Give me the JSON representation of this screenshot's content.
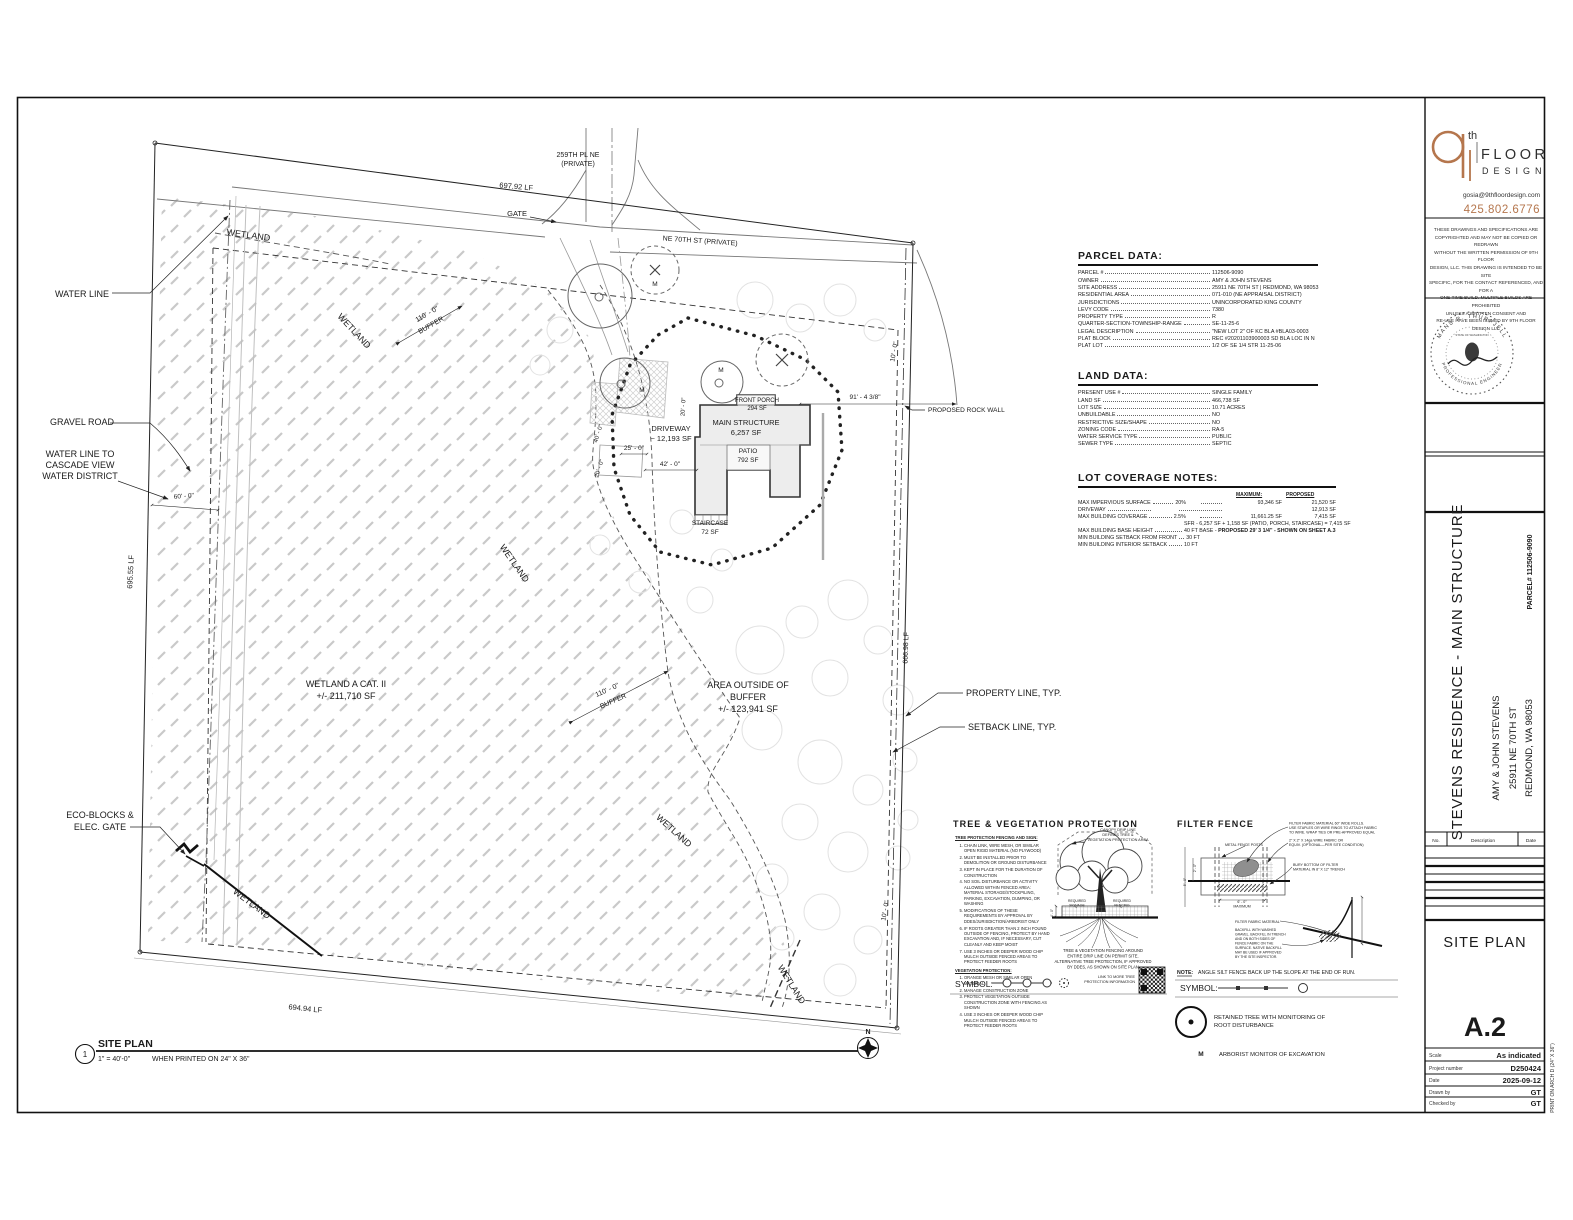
{
  "brand": {
    "sup": "th",
    "floor": "FLOOR",
    "design": "DESIGN",
    "email": "gosia@9thfloordesign.com",
    "phone": "425.802.6776",
    "accent": "#b5764d"
  },
  "copyright_lines": [
    "THESE DRAWINGS AND SPECIFICATIONS ARE",
    "COPYRIGHTED AND MAY NOT BE COPIED OR REDRAWN",
    "WITHOUT THE WRITTEN PERMISSION OF 9TH FLOOR",
    "DESIGN, LLC. THIS DRAWING IS INTENDED TO BE SITE",
    "SPECIFIC, FOR THE CONTACT REFERENCED, AND FOR A",
    "ONE-TIME BUILD. MULTIPLE BUILDS ARE PROHIBITED",
    "UNLESS A WRITTEN CONSENT AND",
    "RE-USE HAVE BEEN ISSUED BY 9TH FLOOR DESIGN LLC"
  ],
  "stamp": {
    "name": "MANS R. THURFJELL",
    "title": "PROFESSIONAL ENGINEER",
    "state": "STATE OF WASHINGTON"
  },
  "project": {
    "title": "STEVENS RESIDENCE - MAIN STRUCTURE",
    "client": "AMY & JOHN STEVENS",
    "address1": "25911 NE 70TH ST",
    "address2": "REDMOND, WA 98053",
    "parcel": "PARCEL# 112506-9090"
  },
  "revisions": {
    "no": "No.",
    "description": "Description",
    "date": "Date"
  },
  "titleblock": {
    "sheet_name": "SITE PLAN",
    "sheet_number": "A.2",
    "rows": [
      {
        "label": "Scale",
        "value": "As indicated"
      },
      {
        "label": "Project number",
        "value": "D250424"
      },
      {
        "label": "Date",
        "value": "2025-09-12"
      },
      {
        "label": "Drawn by",
        "value": "GT"
      },
      {
        "label": "Checked by",
        "value": "GT"
      }
    ],
    "print_note": "PRINT ON ARCH D (24\" X 36\")"
  },
  "parcel_data": {
    "title": "PARCEL DATA:",
    "rows": [
      {
        "l": "PARCEL #",
        "v": "112506-9090"
      },
      {
        "l": "OWNER",
        "v": "AMY & JOHN STEVENS"
      },
      {
        "l": "SITE ADDRESS",
        "v": "25911 NE 70TH ST  |  REDMOND, WA 98053"
      },
      {
        "l": "RESIDENTIAL AREA",
        "v": "071-010 (NE APPRAISAL DISTRICT)"
      },
      {
        "l": "JURISDICTIONS",
        "v": "UNINCORPORATED KING COUNTY"
      },
      {
        "l": "LEVY CODE",
        "v": "7380"
      },
      {
        "l": "PROPERTY TYPE",
        "v": "R"
      },
      {
        "l": "QUARTER-SECTION-TOWNSHIP-RANGE",
        "v": "SE-11-25-6"
      },
      {
        "l": "LEGAL DESCRIPTION",
        "v": "\"NEW LOT 2\" OF KC BLA #BLA03-0003"
      },
      {
        "l": "PLAT BLOCK",
        "v": "REC #20201103900003 SD BLA LOC IN N"
      },
      {
        "l": "PLAT LOT",
        "v": "1/2 OF SE 1/4 STR 11-25-06"
      }
    ]
  },
  "land_data": {
    "title": "LAND DATA:",
    "rows": [
      {
        "l": "PRESENT USE #",
        "v": "SINGLE FAMILY"
      },
      {
        "l": "LAND SF",
        "v": "466,738 SF"
      },
      {
        "l": "LOT SIZE",
        "v": "10.71 ACRES"
      },
      {
        "l": "UNBUILDABLE",
        "v": "NO"
      },
      {
        "l": "RESTRICTIVE SIZE/SHAPE",
        "v": "NO"
      },
      {
        "l": "ZONING CODE",
        "v": "RA-5"
      },
      {
        "l": "WATER SERVICE TYPE",
        "v": "PUBLIC"
      },
      {
        "l": "SEWER TYPE",
        "v": "SEPTIC"
      }
    ]
  },
  "lot_coverage": {
    "title": "LOT COVERAGE NOTES:",
    "col_maximum": "MAXIMUM:",
    "col_proposed": "PROPOSED",
    "rows": [
      {
        "l": "MAX IMPERVIOUS SURFACE",
        "m": "20%",
        "x": "93,346 SF",
        "p": "21,520 SF"
      },
      {
        "l": "DRIVEWAY",
        "m": "",
        "x": "",
        "p": "12,913 SF"
      },
      {
        "l": "MAX BUILDING COVERAGE",
        "m": "2.5%",
        "x": "11,661.25 SF",
        "p": "7,415 SF"
      },
      {
        "note": "SFR - 6,257 SF + 1,158 SF (PATIO, PORCH, STAIRCASE)  = 7,415 SF"
      },
      {
        "l": "MAX BUILDING BASE HEIGHT",
        "w": "40 FT BASE - ",
        "wb": "PROPOSED 29' 3 1/4\" - SHOWN ON SHEET A.3"
      },
      {
        "l": "MIN BUILDING SETBACK FROM FRONT",
        "w": "30 FT"
      },
      {
        "l": "MIN BUILDING INTERIOR SETBACK",
        "w": "10 FT"
      }
    ]
  },
  "tree_detail": {
    "sec1_title": "TREE PROTECTION FENCING AND SIGN:",
    "sec1": [
      "CHAIN LINK, WIRE MESH, OR SIMILAR OPEN RIGID MATERIAL (NO PLYWOOD)",
      "MUST BE INSTALLED PRIOR TO DEMOLITION OR GROUND DISTURBANCE",
      "KEPT IN PLACE FOR THE DURATION OF CONSTRUCTION",
      "NO SOIL DISTURBANCE OR ACTIVITY ALLOWED WITHIN FENCED AREA: MATERIAL STORAGE/STOCKPILING, PARKING, EXCAVATION, DUMPING, OR WASHING",
      "MODIFICATIONS OF THESE REQUIREMENTS BY APPROVAL BY DDES/JURISDICTION/ARBORIST ONLY",
      "IF ROOTS GREATER THAN 2 INCH FOUND OUTSIDE OF FENCING, PROTECT BY HAND EXCAVATION AND, IF NECESSARY, CUT CLEANLY AND KEEP MOIST",
      "USE 3 INCHES OR DEEPER WOOD CHIP MULCH OUTSIDE FENCED AREAS TO PROTECT FEEDER ROOTS"
    ],
    "sec2_title": "VEGETATION PROTECTION:",
    "sec2": [
      "ORANGE MESH OR SIMILAR OPEN MATERIAL",
      "MANAGE CONSTRUCTION ZONE",
      "PROTECT VEGETATION OUTSIDE CONSTRUCTION ZONE WITH FENCING AS SHOWN",
      "USE 3 INCHES OR DEEPER WOOD CHIP MULCH OUTSIDE FENCED AREAS TO PROTECT FEEDER ROOTS"
    ]
  },
  "labels": [
    {
      "t": "TREE & VEGETATION PROTECTION",
      "x": 953,
      "y": 827,
      "s": 9,
      "a": "s",
      "b": 1,
      "ls": 1.1
    },
    {
      "t": "FILTER FENCE",
      "x": 1177,
      "y": 827,
      "s": 9,
      "a": "s",
      "b": 1,
      "ls": 1.1
    },
    {
      "t": "WETLAND",
      "x": 248,
      "y": 238,
      "s": 9,
      "r": 8
    },
    {
      "t": "WATER LINE",
      "x": 82,
      "y": 297,
      "s": 9
    },
    {
      "t": "WETLAND",
      "x": 352,
      "y": 333,
      "s": 9,
      "r": 47
    },
    {
      "t": "110' - 0\"",
      "x": 428,
      "y": 316,
      "s": 7,
      "r": -30
    },
    {
      "t": "BUFFER",
      "x": 432,
      "y": 327,
      "s": 7,
      "r": -30
    },
    {
      "t": "GRAVEL ROAD",
      "x": 82,
      "y": 425,
      "s": 9
    },
    {
      "t": "WATER LINE TO",
      "x": 80,
      "y": 457,
      "s": 9
    },
    {
      "t": "CASCADE VIEW",
      "x": 80,
      "y": 468,
      "s": 9
    },
    {
      "t": "WATER DISTRICT",
      "x": 80,
      "y": 479,
      "s": 9
    },
    {
      "t": "60' - 0\"",
      "x": 184,
      "y": 498,
      "s": 6.5,
      "r": -4
    },
    {
      "t": "695.55 LF",
      "x": 133,
      "y": 572,
      "s": 7.5,
      "r": -87
    },
    {
      "t": "WETLAND A CAT. II",
      "x": 346,
      "y": 687,
      "s": 9
    },
    {
      "t": "+/- 211,710 SF",
      "x": 346,
      "y": 699,
      "s": 9
    },
    {
      "t": "WETLAND",
      "x": 512,
      "y": 565,
      "s": 9,
      "r": 55
    },
    {
      "t": "WETLAND",
      "x": 672,
      "y": 833,
      "s": 9,
      "r": 42
    },
    {
      "t": "110' - 0\"",
      "x": 608,
      "y": 692,
      "s": 7,
      "r": -24
    },
    {
      "t": "BUFFER",
      "x": 614,
      "y": 703,
      "s": 7,
      "r": -24
    },
    {
      "t": "AREA OUTSIDE OF",
      "x": 748,
      "y": 688,
      "s": 9
    },
    {
      "t": "BUFFER",
      "x": 748,
      "y": 700,
      "s": 9
    },
    {
      "t": "+/- 123,941 SF",
      "x": 748,
      "y": 712,
      "s": 9
    },
    {
      "t": "PROPERTY LINE, TYP.",
      "x": 966,
      "y": 696,
      "s": 9,
      "a": "s"
    },
    {
      "t": "SETBACK LINE, TYP.",
      "x": 968,
      "y": 730,
      "s": 9,
      "a": "s"
    },
    {
      "t": "PROPOSED ROCK WALL",
      "x": 928,
      "y": 412,
      "s": 6.5,
      "a": "s"
    },
    {
      "t": "666.98 LF",
      "x": 908,
      "y": 648,
      "s": 7,
      "r": -88
    },
    {
      "t": "10' - 0\"",
      "x": 896,
      "y": 352,
      "s": 6.5,
      "r": -80
    },
    {
      "t": "10' - 0\"",
      "x": 887,
      "y": 911,
      "s": 6.5,
      "r": -80
    },
    {
      "t": "ECO-BLOCKS &",
      "x": 100,
      "y": 818,
      "s": 9
    },
    {
      "t": "ELEC. GATE",
      "x": 100,
      "y": 830,
      "s": 9
    },
    {
      "t": "WETLAND",
      "x": 250,
      "y": 906,
      "s": 9,
      "r": 37
    },
    {
      "t": "WETLAND",
      "x": 789,
      "y": 986,
      "s": 9,
      "r": 58
    },
    {
      "t": "694.94 LF",
      "x": 305,
      "y": 1011,
      "s": 7.5,
      "r": 6
    },
    {
      "t": "GATE",
      "x": 527,
      "y": 216,
      "s": 7.5,
      "a": "e"
    },
    {
      "t": "697.92 LF",
      "x": 516,
      "y": 189,
      "s": 7.5,
      "r": 5
    },
    {
      "t": "259TH PL NE",
      "x": 578,
      "y": 157,
      "s": 7
    },
    {
      "t": "(PRIVATE)",
      "x": 578,
      "y": 166,
      "s": 7
    },
    {
      "t": "NE 70TH ST (PRIVATE)",
      "x": 700,
      "y": 243,
      "s": 7,
      "r": 4
    },
    {
      "t": "FRONT PORCH",
      "x": 757,
      "y": 402,
      "s": 6
    },
    {
      "t": "294 SF",
      "x": 757,
      "y": 410,
      "s": 6
    },
    {
      "t": "MAIN STRUCTURE",
      "x": 746,
      "y": 425,
      "s": 7.5
    },
    {
      "t": "6,257 SF",
      "x": 746,
      "y": 435,
      "s": 7.5
    },
    {
      "t": "DRIVEWAY",
      "x": 671,
      "y": 431,
      "s": 7.5
    },
    {
      "t": "~ 12,193 SF",
      "x": 671,
      "y": 441,
      "s": 7.5
    },
    {
      "t": "PATIO",
      "x": 748,
      "y": 453,
      "s": 6.5
    },
    {
      "t": "792 SF",
      "x": 748,
      "y": 462,
      "s": 6.5
    },
    {
      "t": "STAIRCASE",
      "x": 710,
      "y": 525,
      "s": 6.5
    },
    {
      "t": "72 SF",
      "x": 710,
      "y": 534,
      "s": 6.5
    },
    {
      "t": "91' - 4 3/8\"",
      "x": 865,
      "y": 399,
      "s": 6.5
    },
    {
      "t": "42' - 0\"",
      "x": 670,
      "y": 466,
      "s": 6.5
    },
    {
      "t": "25' - 0\"",
      "x": 634,
      "y": 450,
      "s": 6.5
    },
    {
      "t": "20' - 0\"",
      "x": 685,
      "y": 407,
      "s": 6,
      "r": -87
    },
    {
      "t": "40' - 0\"",
      "x": 600,
      "y": 434,
      "s": 6,
      "r": -72
    },
    {
      "t": "20' - 0\"",
      "x": 601,
      "y": 469,
      "s": 6,
      "r": -72
    },
    {
      "t": "M",
      "x": 642,
      "y": 392,
      "s": 6.5
    },
    {
      "t": "M",
      "x": 721,
      "y": 372,
      "s": 6.5
    },
    {
      "t": "M",
      "x": 655,
      "y": 286,
      "s": 6.5
    },
    {
      "t": "N",
      "x": 868,
      "y": 1034,
      "s": 7,
      "b": 1
    },
    {
      "t": "1",
      "x": 85,
      "y": 1057,
      "s": 8
    },
    {
      "t": "SITE PLAN",
      "x": 98,
      "y": 1047,
      "s": 10.5,
      "a": "s",
      "b": 1
    },
    {
      "t": "1\" = 40'-0\"",
      "x": 98,
      "y": 1061,
      "s": 7,
      "a": "s"
    },
    {
      "t": "WHEN PRINTED ON 24\" X 36\"",
      "x": 152,
      "y": 1061,
      "s": 7,
      "a": "s"
    },
    {
      "t": "CANOPY DRIP LINE",
      "x": 1118,
      "y": 831,
      "s": 3.8
    },
    {
      "t": "DEFINES TREE &",
      "x": 1118,
      "y": 836,
      "s": 3.8
    },
    {
      "t": "VEGETATION PROTECTION AREA",
      "x": 1118,
      "y": 841,
      "s": 3.8
    },
    {
      "t": "REQUIRED",
      "x": 1077,
      "y": 902,
      "s": 3.4
    },
    {
      "t": "SIGNAGE",
      "x": 1077,
      "y": 906.5,
      "s": 3.4
    },
    {
      "t": "REQUIRED",
      "x": 1122,
      "y": 902,
      "s": 3.4
    },
    {
      "t": "FENCING",
      "x": 1122,
      "y": 906.5,
      "s": 3.4
    },
    {
      "t": "4' - 0\"",
      "x": 1053,
      "y": 913,
      "s": 3.2,
      "r": -90
    },
    {
      "t": "TREE & VEGETATION FENCING AROUND",
      "x": 1103,
      "y": 952,
      "s": 4.1
    },
    {
      "t": "ENTIRE DRIP LINE ON PERMIT SITE.",
      "x": 1103,
      "y": 957.5,
      "s": 4.1
    },
    {
      "t": "ALTERNATIVE TREE PROTECTION, IF APPROVED",
      "x": 1103,
      "y": 963,
      "s": 4.1
    },
    {
      "t": "BY DDES, AS SHOWN ON SITE PLAN",
      "x": 1103,
      "y": 968.5,
      "s": 4.1
    },
    {
      "t": "LINK TO MORE TREE",
      "x": 1135,
      "y": 978,
      "s": 3.7,
      "a": "e"
    },
    {
      "t": "PROTECTION INFORMATION",
      "x": 1135,
      "y": 983,
      "s": 3.7,
      "a": "e"
    },
    {
      "t": "SYMBOL:",
      "x": 955,
      "y": 987,
      "s": 8.5,
      "a": "s"
    },
    {
      "t": "FILTER FABRIC MATERIAL 60\" WIDE ROLLS.",
      "x": 1289,
      "y": 824.5,
      "s": 3.6,
      "a": "s"
    },
    {
      "t": "USE STAPLES OR WIRE RINGS TO ATTACH FABRIC",
      "x": 1289,
      "y": 829,
      "s": 3.6,
      "a": "s"
    },
    {
      "t": "TO WIRE. WRAP TIES OR PRE-APPROVED EQUAL",
      "x": 1289,
      "y": 833.5,
      "s": 3.6,
      "a": "s"
    },
    {
      "t": "METAL FENCE POSTS",
      "x": 1225,
      "y": 846,
      "s": 3.6,
      "a": "s"
    },
    {
      "t": "2\" X 2\" X 14ga WIRE FABRIC OR",
      "x": 1289,
      "y": 841.5,
      "s": 3.6,
      "a": "s"
    },
    {
      "t": "EQUIV. (OPTIONAL—PER SITE CONDITION)",
      "x": 1289,
      "y": 846,
      "s": 3.6,
      "a": "s"
    },
    {
      "t": "BURY BOTTOM OF FILTER",
      "x": 1293,
      "y": 866,
      "s": 3.6,
      "a": "s"
    },
    {
      "t": "MATERIAL IN 8\" X 12\" TRENCH",
      "x": 1293,
      "y": 870.5,
      "s": 3.6,
      "a": "s"
    },
    {
      "t": "2' - 0\"",
      "x": 1196,
      "y": 868,
      "s": 3.2,
      "r": -90
    },
    {
      "t": "5' - 0\"",
      "x": 1186,
      "y": 882,
      "s": 3.2,
      "r": -90
    },
    {
      "t": "6' - 0\"",
      "x": 1242,
      "y": 903,
      "s": 3.6
    },
    {
      "t": "MAXIMUM",
      "x": 1242,
      "y": 907.5,
      "s": 3.6
    },
    {
      "t": "FILTER FABRIC  MATERIAL",
      "x": 1235,
      "y": 923,
      "s": 3.6,
      "a": "s"
    },
    {
      "t": "BACKFILL WITH WASHED",
      "x": 1235,
      "y": 931,
      "s": 3.4,
      "a": "s"
    },
    {
      "t": "GRAVEL. BACKFILL IN TRENCH",
      "x": 1235,
      "y": 935.5,
      "s": 3.4,
      "a": "s"
    },
    {
      "t": "AND ON BOTH SIDES OF",
      "x": 1235,
      "y": 940,
      "s": 3.4,
      "a": "s"
    },
    {
      "t": "FENCE FABRIC ON THE",
      "x": 1235,
      "y": 944.5,
      "s": 3.4,
      "a": "s"
    },
    {
      "t": "SURFACE. NATIVE BACKFILL",
      "x": 1235,
      "y": 949,
      "s": 3.4,
      "a": "s"
    },
    {
      "t": "MAY BE USED IF APPROVED",
      "x": 1235,
      "y": 953.5,
      "s": 3.4,
      "a": "s"
    },
    {
      "t": "BY THE SITE INSPECTOR.",
      "x": 1235,
      "y": 958,
      "s": 3.4,
      "a": "s"
    },
    {
      "t": "NOTE:",
      "x": 1177,
      "y": 974,
      "s": 5.2,
      "a": "s",
      "b": 1
    },
    {
      "t": "ANGLE SILT FENCE BACK UP THE SLOPE AT THE END OF RUN.",
      "x": 1198,
      "y": 974,
      "s": 5.2,
      "a": "s"
    },
    {
      "t": "SYMBOL:",
      "x": 1180,
      "y": 991,
      "s": 8.5,
      "a": "s"
    },
    {
      "t": "RETAINED TREE WITH MONITORING OF",
      "x": 1214,
      "y": 1019,
      "s": 5.8,
      "a": "s"
    },
    {
      "t": "ROOT DISTURBANCE",
      "x": 1214,
      "y": 1027,
      "s": 5.8,
      "a": "s"
    },
    {
      "t": "M",
      "x": 1201,
      "y": 1056,
      "s": 6.5,
      "b": 1
    },
    {
      "t": "ARBORIST MONITOR OF EXCAVATION",
      "x": 1219,
      "y": 1056,
      "s": 5.8,
      "a": "s"
    }
  ]
}
